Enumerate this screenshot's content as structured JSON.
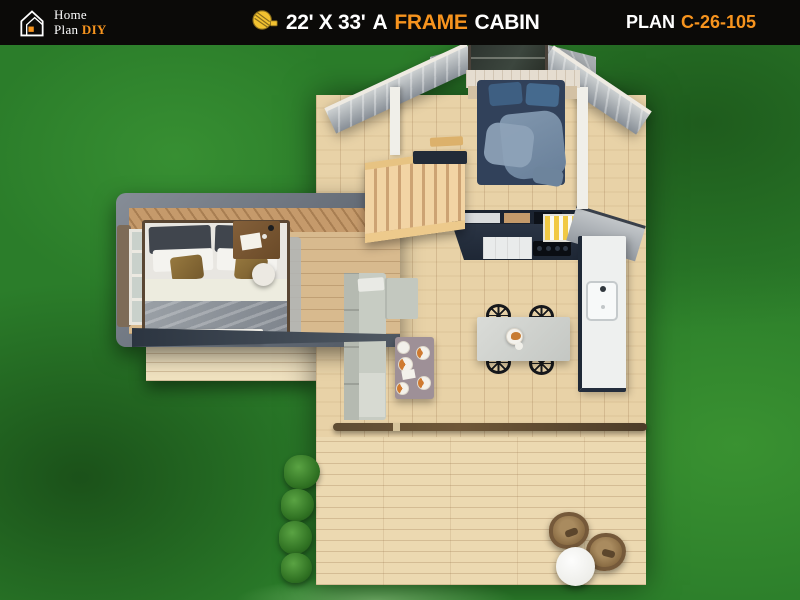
{
  "header": {
    "logo": {
      "icon": "house-logo-icon",
      "line1": "Home",
      "line2": "Plan",
      "line2_accent": "DIY"
    },
    "title": {
      "icon": "tape-measure-icon",
      "dimensions": "22' X 33'",
      "article": "A",
      "accent_word": "FRAME",
      "last_word": "CABIN"
    },
    "plan": {
      "label": "PLAN",
      "number": "C-26-105"
    }
  },
  "colors": {
    "header_bg": "#0B0A08",
    "accent_orange": "#F7941E",
    "text_white": "#FFFFFF",
    "grass_green": "#2B7D2A",
    "deck_wood": "#E8D2A7",
    "roof_gray": "#9AA0A6",
    "kitchen_navy": "#232C3B",
    "loft_bed_blue": "#31415A",
    "sofa_gray": "#C7CCC3"
  },
  "scene_objects": [
    "grass-lawn",
    "main-deck",
    "outdoor-deck",
    "left-wing-bedroom",
    "loft-bedroom",
    "a-frame-roof-slopes",
    "ridge-skylight",
    "staircase",
    "kitchen-counter",
    "kitchen-island",
    "sink",
    "dining-table",
    "dining-chairs",
    "breakfast-plate",
    "sectional-sofa",
    "coffee-table",
    "pizza-plates",
    "double-bed-gray",
    "double-bed-blue",
    "desk",
    "ottoman",
    "rug",
    "window",
    "garden-bushes",
    "lounge-chairs",
    "patio-table"
  ]
}
